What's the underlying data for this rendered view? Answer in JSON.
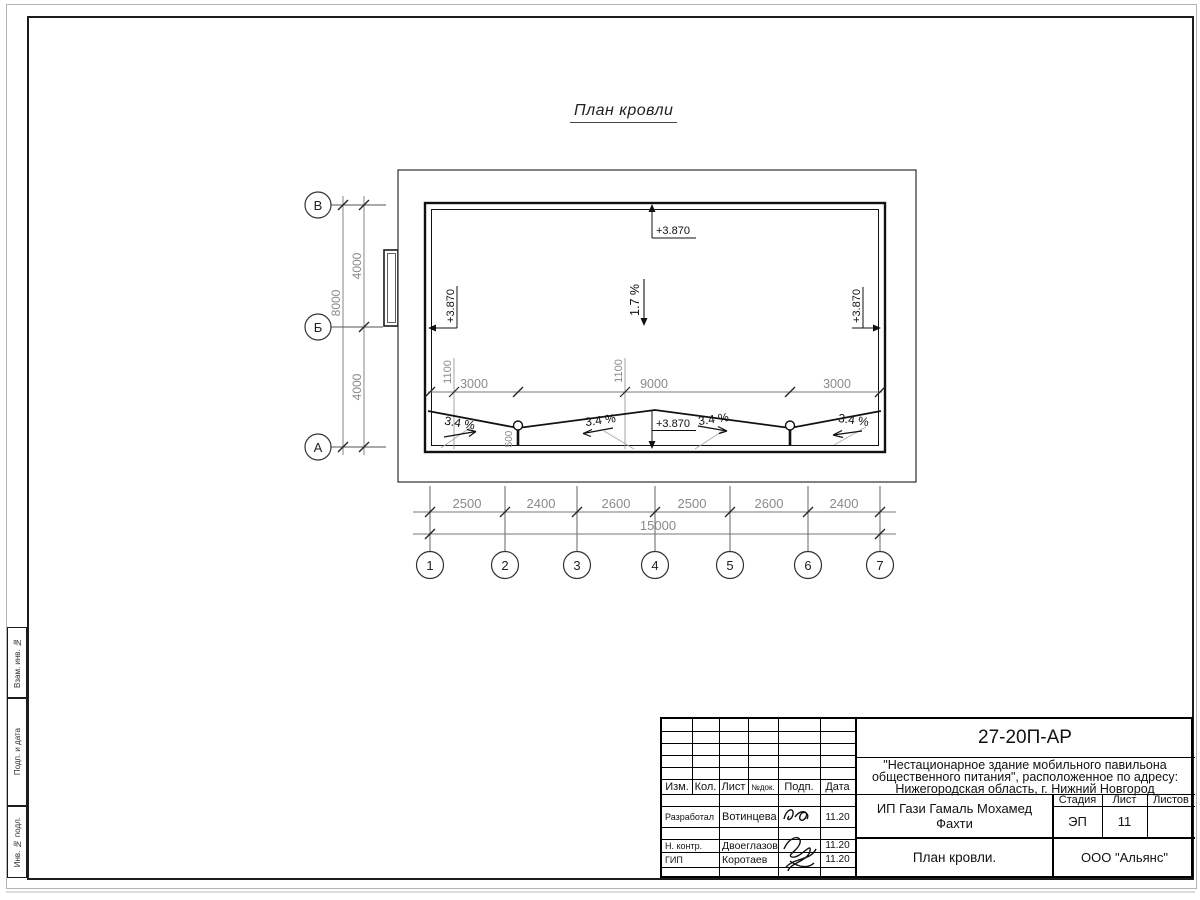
{
  "sheet": {
    "title": "План кровли"
  },
  "plan": {
    "elevation": "+3.870",
    "slope_main": "1.7 %",
    "slope_local": "3.4 %",
    "drain_dim": "500",
    "offset_dims": [
      "1100",
      "1100"
    ],
    "ridge_dims": [
      "3000",
      "9000",
      "3000"
    ],
    "row_axes": {
      "labels": [
        "В",
        "Б",
        "А"
      ],
      "segments": [
        "4000",
        "4000"
      ],
      "total": "8000"
    },
    "col_axes": {
      "labels": [
        "1",
        "2",
        "3",
        "4",
        "5",
        "6",
        "7"
      ],
      "segments": [
        "2500",
        "2400",
        "2600",
        "2500",
        "2600",
        "2400"
      ],
      "total": "15000"
    }
  },
  "frame_stamps": [
    "Взам. инв. №",
    "Подп. и дата",
    "Инв. № подл."
  ],
  "title_block": {
    "doc_code": "27-20П-АР",
    "project_line1": "\"Нестационарное здание мобильного павильона",
    "project_line2": "общественного питания\", расположенное по адресу:",
    "project_line3": "Нижегородская область, г. Нижний Новгород",
    "client": "ИП Гази Гамаль Мохамед Фахти",
    "sheet_name": "План кровли.",
    "org": "ООО \"Альянс\"",
    "header": {
      "izm": "Изм.",
      "kol": "Кол.",
      "list": "Лист",
      "ndok": "№док.",
      "podp": "Подп.",
      "data": "Дата"
    },
    "stage_header": {
      "stage": "Стадия",
      "sheet": "Лист",
      "sheets": "Листов"
    },
    "stage_values": {
      "stage": "ЭП",
      "sheet": "11",
      "sheets": ""
    },
    "rows": [
      {
        "role": "Разработал",
        "name": "Вотинцева",
        "date": "11.20"
      },
      {
        "role": "Н. контр.",
        "name": "Двоеглазов",
        "date": "11.20"
      },
      {
        "role": "ГИП",
        "name": "Коротаев",
        "date": "11.20"
      }
    ]
  }
}
